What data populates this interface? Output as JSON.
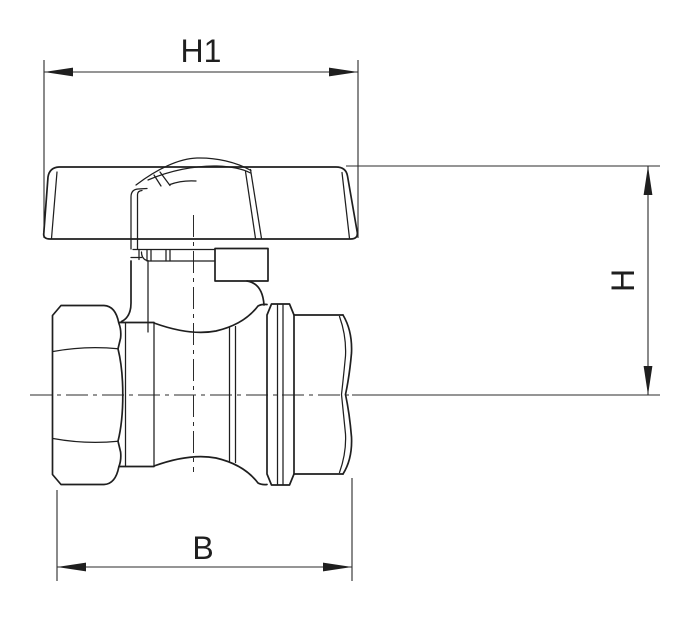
{
  "diagram": {
    "subject": "ball-valve-with-butterfly-handle-side-view",
    "background_color": "#ffffff",
    "line_color": "#1f1f1f",
    "dimension_color": "#2b2b2b",
    "dimensions": {
      "h1": {
        "label": "H1"
      },
      "h": {
        "label": "H"
      },
      "b": {
        "label": "B"
      }
    }
  }
}
